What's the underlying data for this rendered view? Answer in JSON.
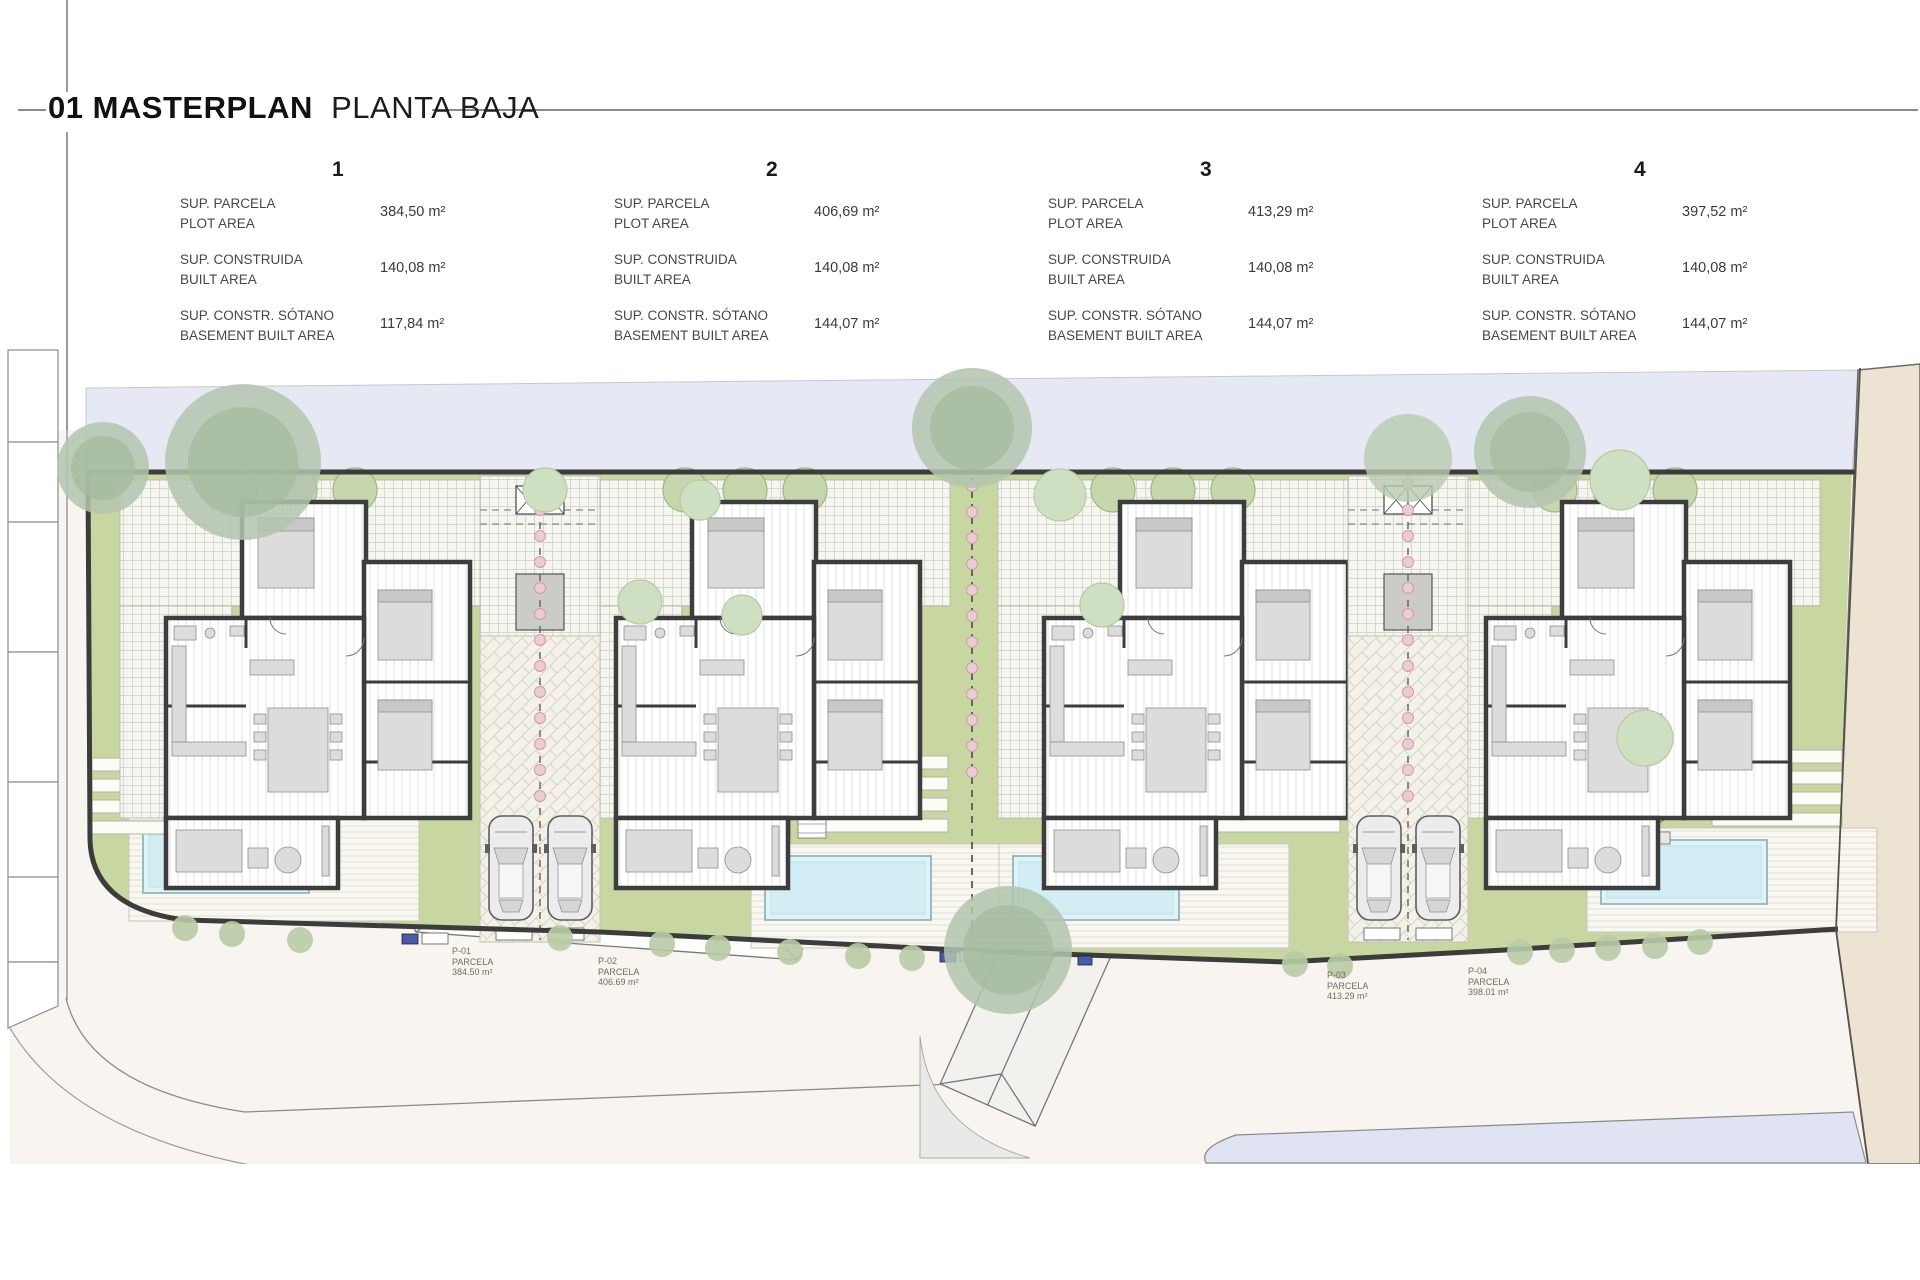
{
  "header": {
    "index_title": "01 MASTERPLAN",
    "subtitle": "PLANTA BAJA"
  },
  "plots": [
    {
      "number": "1",
      "rows": [
        {
          "label_es": "SUP. PARCELA",
          "label_en": "PLOT AREA",
          "value": "384,50 m²"
        },
        {
          "label_es": "SUP. CONSTRUIDA",
          "label_en": "BUILT AREA",
          "value": "140,08 m²"
        },
        {
          "label_es": "SUP. CONSTR. SÓTANO",
          "label_en": "BASEMENT BUILT AREA",
          "value": "117,84 m²"
        }
      ],
      "parcel_tag": {
        "code": "P-01",
        "name": "PARCELA",
        "area": "384.50 m²"
      }
    },
    {
      "number": "2",
      "rows": [
        {
          "label_es": "SUP. PARCELA",
          "label_en": "PLOT AREA",
          "value": "406,69 m²"
        },
        {
          "label_es": "SUP. CONSTRUIDA",
          "label_en": "BUILT AREA",
          "value": "140,08 m²"
        },
        {
          "label_es": "SUP. CONSTR. SÓTANO",
          "label_en": "BASEMENT BUILT AREA",
          "value": "144,07 m²"
        }
      ],
      "parcel_tag": {
        "code": "P-02",
        "name": "PARCELA",
        "area": "406.69 m²"
      }
    },
    {
      "number": "3",
      "rows": [
        {
          "label_es": "SUP. PARCELA",
          "label_en": "PLOT AREA",
          "value": "413,29 m²"
        },
        {
          "label_es": "SUP. CONSTRUIDA",
          "label_en": "BUILT AREA",
          "value": "140,08 m²"
        },
        {
          "label_es": "SUP. CONSTR. SÓTANO",
          "label_en": "BASEMENT BUILT AREA",
          "value": "144,07 m²"
        }
      ],
      "parcel_tag": {
        "code": "P-03",
        "name": "PARCELA",
        "area": "413.29 m²"
      }
    },
    {
      "number": "4",
      "rows": [
        {
          "label_es": "SUP. PARCELA",
          "label_en": "PLOT AREA",
          "value": "397,52 m²"
        },
        {
          "label_es": "SUP. CONSTRUIDA",
          "label_en": "BUILT AREA",
          "value": "140,08 m²"
        },
        {
          "label_es": "SUP. CONSTR. SÓTANO",
          "label_en": "BASEMENT BUILT AREA",
          "value": "144,07 m²"
        }
      ],
      "parcel_tag": {
        "code": "P-04",
        "name": "PARCELA",
        "area": "398.01 m²"
      }
    }
  ],
  "colors": {
    "site_green": "#c8d6a2",
    "pool_water": "#dff2f6",
    "road_band_top": "#e6e8f4",
    "road_band_bottom": "#dfe3f2",
    "neighbour_beige": "#ece3d3",
    "wall": "#3c3c3c",
    "road_surface": "#f8f4f0"
  }
}
